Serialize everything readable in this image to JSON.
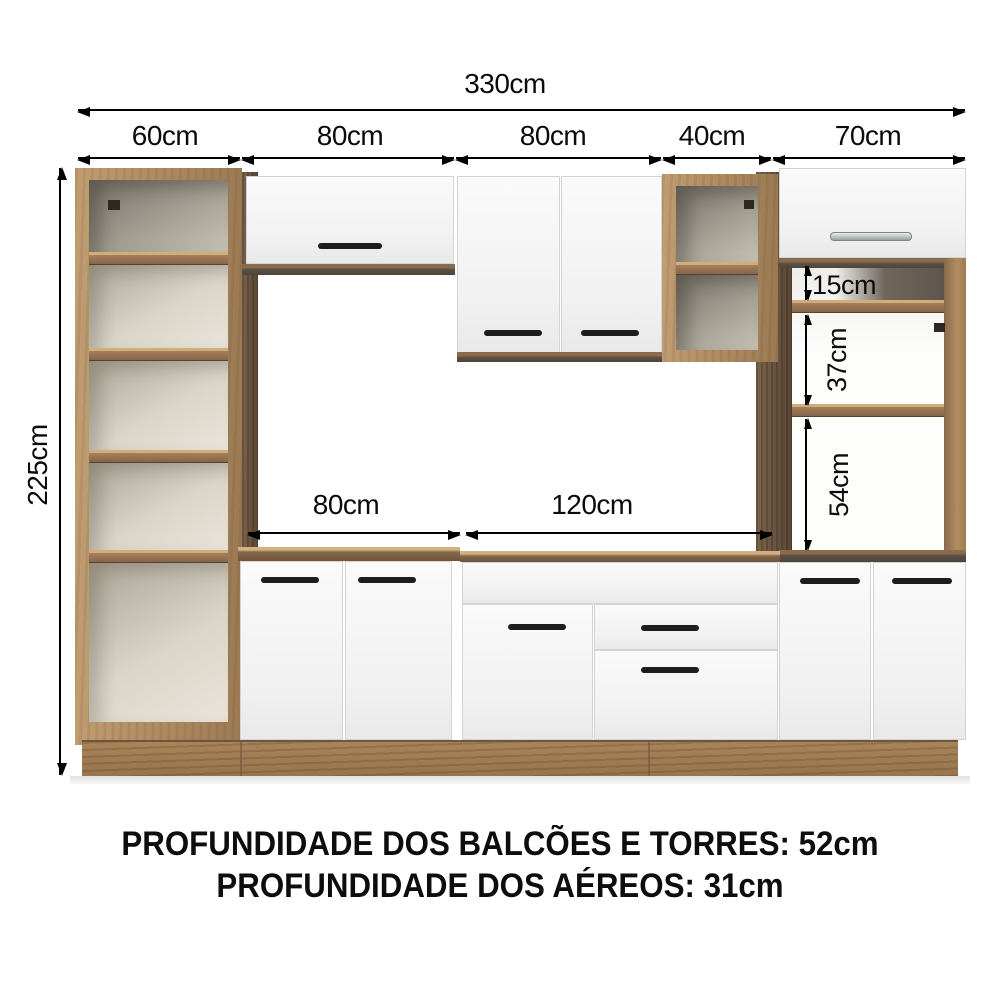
{
  "diagram": {
    "top_dimensions": {
      "total": "330cm",
      "sections": [
        "60cm",
        "80cm",
        "80cm",
        "40cm",
        "70cm"
      ]
    },
    "left_dimension": "225cm",
    "counter_dimensions": [
      "80cm",
      "120cm"
    ],
    "tower_shelf_gaps": [
      "15cm",
      "37cm",
      "54cm"
    ],
    "footer": {
      "line1": "PROFUNDIDADE DOS BALCÕES E TORRES: 52cm",
      "line2": "PROFUNDIDADE DOS AÉREOS: 31cm"
    },
    "colors": {
      "background": "#ffffff",
      "wood_light": "#b7946a",
      "wood_mid": "#a5805a",
      "wood_dark": "#6b5540",
      "door_white": "#f7f7f7",
      "interior_cream": "#e9e5da",
      "handle_dark": "#1d1d1d",
      "handle_metal": "#aab2b2",
      "annotation": "#000000"
    }
  }
}
